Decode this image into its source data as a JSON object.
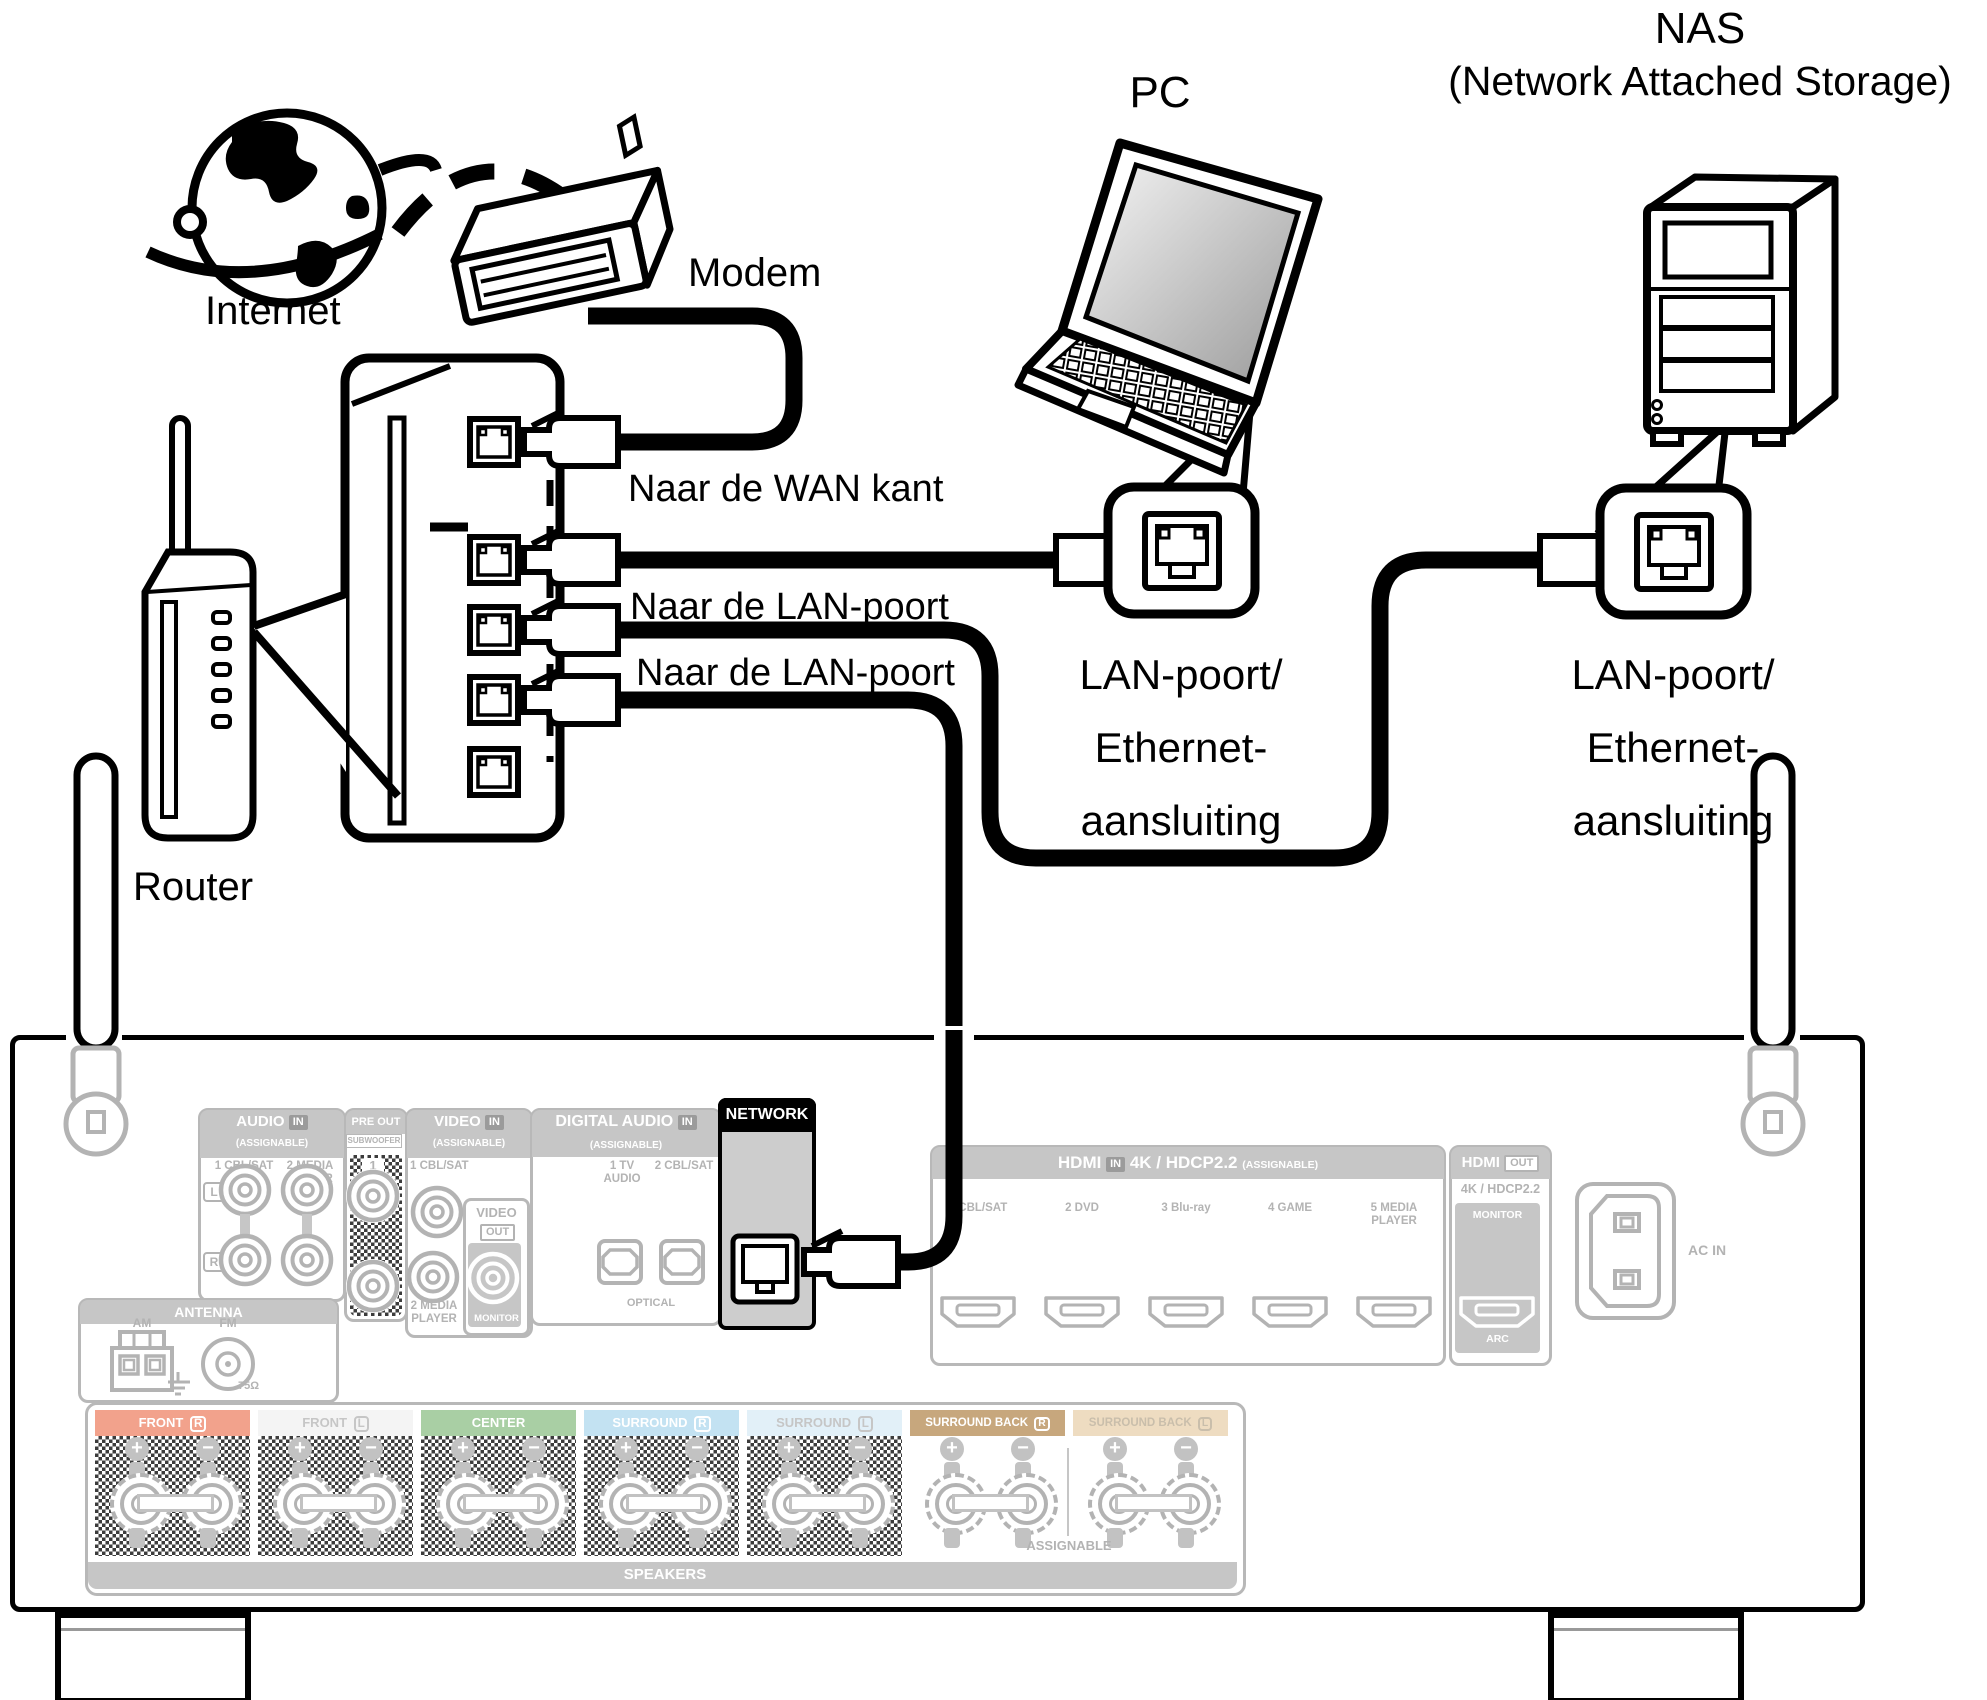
{
  "top": {
    "internet_label": "Internet",
    "modem_label": "Modem",
    "pc_label": "PC",
    "nas_title": "NAS",
    "nas_subtitle": "(Network Attached Storage)",
    "router_label": "Router",
    "to_wan_label": "Naar de WAN kant",
    "to_lan_label_1": "Naar de LAN-poort",
    "to_lan_label_2": "Naar de LAN-poort",
    "pc_callout": "LAN-poort/\nEthernet-\naansluiting",
    "nas_callout": "LAN-poort/\nEthernet-\naansluiting"
  },
  "receiver": {
    "audio": {
      "title": "AUDIO",
      "badge": "IN",
      "assignable": "(ASSIGNABLE)",
      "in1": "1 CBL/SAT",
      "in2": "2 MEDIA\nPLAYER",
      "left": "L",
      "right": "R"
    },
    "pre_out": {
      "title": "PRE OUT",
      "subwoofer": "SUBWOOFER",
      "jack1": "1",
      "jack2": "2"
    },
    "video": {
      "title": "VIDEO",
      "badge": "IN",
      "assignable": "(ASSIGNABLE)",
      "in1": "1 CBL/SAT",
      "in2": "2 MEDIA\nPLAYER",
      "out_title": "VIDEO",
      "out_badge": "OUT",
      "monitor": "MONITOR"
    },
    "digital_audio": {
      "title": "DIGITAL AUDIO",
      "badge": "IN",
      "assignable": "(ASSIGNABLE)",
      "in1": "1 TV\nAUDIO",
      "in2": "2 CBL/SAT",
      "optical": "OPTICAL"
    },
    "network": {
      "title": "NETWORK"
    },
    "hdmi_in": {
      "title": "HDMI",
      "badge": "IN",
      "spec": "4K / HDCP2.2",
      "assignable": "(ASSIGNABLE)",
      "ports": [
        {
          "num": "1",
          "name": "CBL/SAT"
        },
        {
          "num": "2",
          "name": "DVD"
        },
        {
          "num": "3",
          "name": "Blu-ray"
        },
        {
          "num": "4",
          "name": "GAME"
        },
        {
          "num": "5",
          "name": "MEDIA\nPLAYER"
        }
      ]
    },
    "hdmi_out": {
      "title": "HDMI",
      "badge": "OUT",
      "spec": "4K / HDCP2.2",
      "monitor": "MONITOR",
      "arc": "ARC"
    },
    "ac_in_label": "AC IN",
    "antenna": {
      "title": "ANTENNA",
      "am": "AM",
      "fm": "FM",
      "ohm": "75Ω"
    },
    "speakers": {
      "plus": "+",
      "minus": "−",
      "assignable": "ASSIGNABLE",
      "footer": "SPEAKERS",
      "groups": [
        {
          "name": "FRONT",
          "side": "R",
          "bg": "#f2a28c",
          "fg": "#ffffff",
          "checker": true
        },
        {
          "name": "FRONT",
          "side": "L",
          "bg": "#f4f4f4",
          "fg": "#c6c6c6",
          "checker": true
        },
        {
          "name": "CENTER",
          "side": "",
          "bg": "#a9cfa4",
          "fg": "#ffffff",
          "checker": true
        },
        {
          "name": "SURROUND",
          "side": "R",
          "bg": "#c3e2f2",
          "fg": "#ffffff",
          "checker": true
        },
        {
          "name": "SURROUND",
          "side": "L",
          "bg": "#e2f0f8",
          "fg": "#c6c6c6",
          "checker": true
        },
        {
          "name": "SURROUND BACK",
          "side": "R",
          "bg": "#c7a77d",
          "fg": "#ffffff",
          "checker": false
        },
        {
          "name": "SURROUND BACK",
          "side": "L",
          "bg": "#eedcc1",
          "fg": "#c9beab",
          "checker": false
        }
      ]
    }
  }
}
